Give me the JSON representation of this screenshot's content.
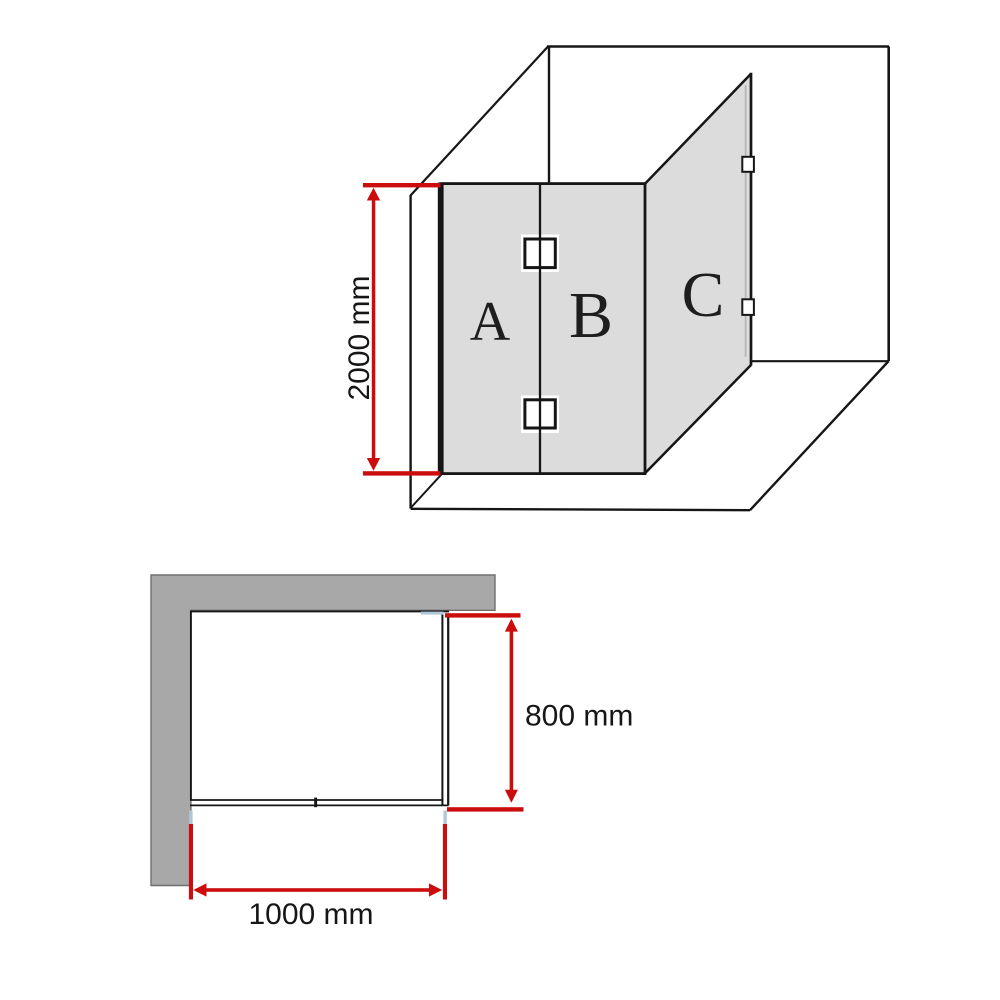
{
  "colors": {
    "dimension_red": "#cc0d0d",
    "glass_gray": "#dcdcdc",
    "wall_gray": "#a8a8a8",
    "ink_black": "#161616",
    "seal_blue": "#b0c7d9",
    "glass_edge_gray": "#b5b5b5",
    "wall_edge_gray": "#6f6f6f",
    "background_white": "#ffffff"
  },
  "isometric_view": {
    "panel_labels": {
      "a": "A",
      "b": "B",
      "c": "C"
    },
    "height_dimension_label": "2000 mm"
  },
  "plan_view": {
    "width_dimension_label": "1000 mm",
    "return_dimension_label": "800 mm"
  }
}
